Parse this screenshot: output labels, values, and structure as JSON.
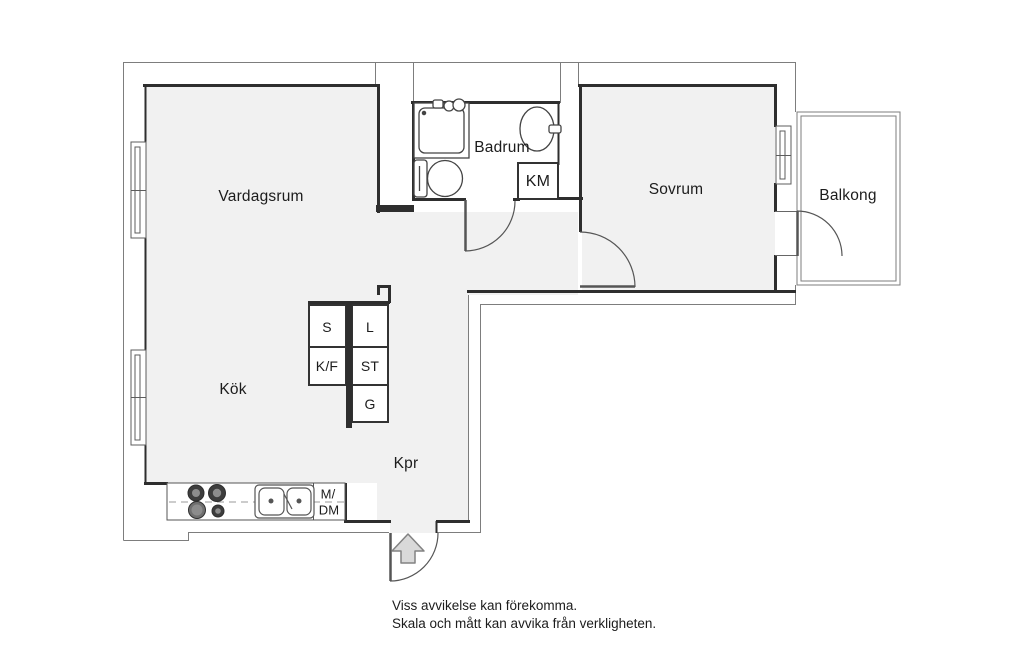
{
  "floorplan": {
    "rooms": {
      "living_room": "Vardagsrum",
      "kitchen": "Kök",
      "bathroom": "Badrum",
      "bedroom": "Sovrum",
      "balcony": "Balkong",
      "hall": "Kpr"
    },
    "closets": {
      "s": "S",
      "l": "L",
      "kf": "K/F",
      "st": "ST",
      "g": "G"
    },
    "appliances": {
      "washing_machine": "KM",
      "micro_dishwasher_line1": "M/",
      "micro_dishwasher_line2": "DM"
    },
    "disclaimer": {
      "line1": "Viss avvikelse kan förekomma.",
      "line2": "Skala och mått kan avvika från verkligheten."
    },
    "icons": {
      "shower": "shower-icon",
      "toilet": "toilet-icon",
      "bathroom_sink": "sink-icon",
      "stove": "stove-icon",
      "kitchen_sink": "double-sink-icon",
      "entry_arrow": "entry-arrow-icon",
      "windows": "window-icon",
      "doors": "door-arc-icon"
    },
    "colors": {
      "background": "#ffffff",
      "floor_fill": "#f1f1f1",
      "wall": "#2e2e2e",
      "outline": "#7d7d7d",
      "thin_line": "#555555",
      "arrow_fill": "#d9d9d9",
      "text": "#1c1c1c"
    }
  }
}
